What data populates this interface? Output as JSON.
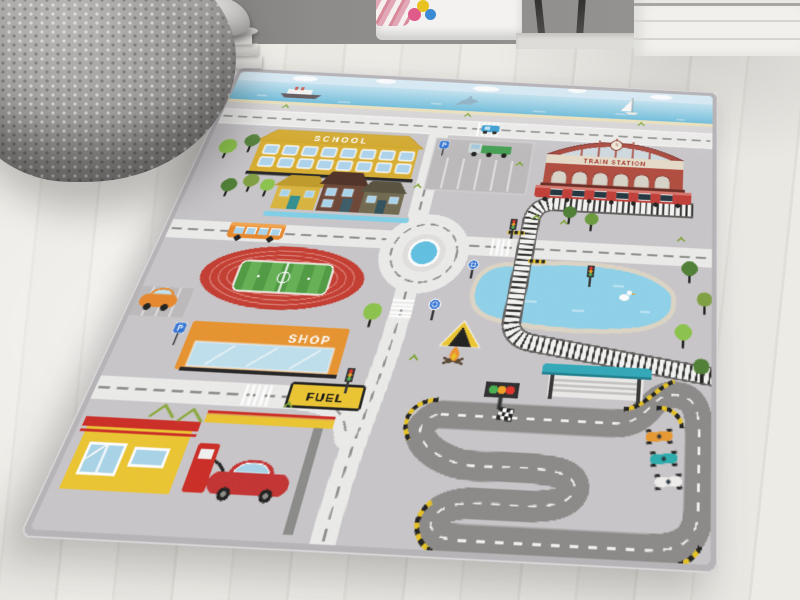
{
  "scene": {
    "type": "photograph",
    "description": "Children's city traffic play rug lying on a light whitewashed wooden floor in a kids room, beside a gray knitted pouf and a stack of books topped with a silver cap ornament",
    "rug_style": "city road play mat with roads, railway, roundabout and race track"
  },
  "room": {
    "wall_color": "#8e8c8a",
    "floor": "light whitewashed wood planks",
    "items": [
      "gray knitted pouf",
      "stack of books",
      "silver cap ornament",
      "white bed with pink blanket and toy",
      "dark stool legs",
      "white dresser"
    ]
  },
  "rug": {
    "base_color": "#c9c6c9",
    "border_color": "#b7b4b7",
    "labels": {
      "school": "SCHOOL",
      "train_station": "TRAIN STATION",
      "shop": "SHOP",
      "fuel": "FUEL",
      "parking_p": "P"
    },
    "features": [
      "sky with clouds",
      "sea with cruise ship, jumping dolphin and sailboat",
      "light roads with dashed markings and zebra crossings",
      "school building with blue windows",
      "red train station with clock and red train",
      "railway line with level crossing crossing a lake",
      "two parking lots with green truck and orange car",
      "row of houses with river",
      "orange city bus",
      "roundabout with blue pond",
      "athletics stadium with red track and green football pitch",
      "shop with orange awning",
      "lake with white duck",
      "yellow camping tent and campfire",
      "fuel station with red pump and red car",
      "dark go-kart race track with start lights, checkered flag, teal grandstand and three race cars",
      "trees, traffic lights and blue road signs"
    ],
    "colors": {
      "road": "#ececea",
      "road_dash": "#8f8f8d",
      "race_track": "#8b8987",
      "water": "#8ed2ea",
      "school_yellow": "#d9ae2e",
      "station_red": "#b04a3c",
      "shop_orange": "#e8922c",
      "fuel_yellow": "#ecc52e",
      "stadium_red": "#c43a2e",
      "pitch_green": "#4e9a40",
      "grandstand_teal": "#2fa8b8"
    }
  }
}
